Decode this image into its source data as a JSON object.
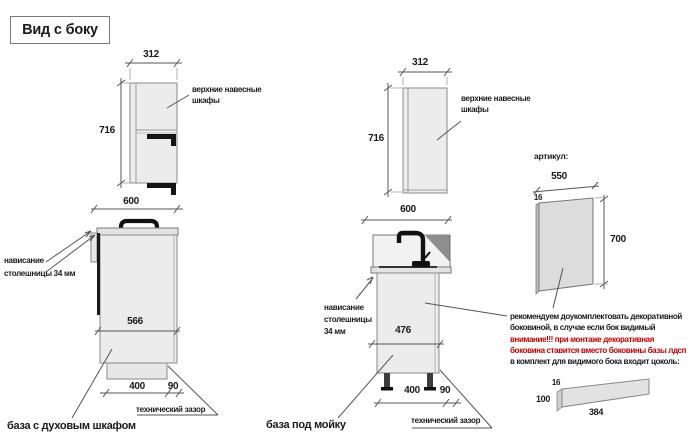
{
  "title": "Вид с боку",
  "units": {
    "oven_base": {
      "label": "база с духовым шкафом",
      "wall_width": "312",
      "wall_height": "716",
      "wall_callout": [
        "верхние навесные",
        "шкафы"
      ],
      "base_width": "600",
      "base_inner_width": "566",
      "plinth_width": "400",
      "tech_gap_width": "90",
      "overhang_note": [
        "нависание",
        "столешницы 34 мм"
      ],
      "tech_gap_label": "технический зазор"
    },
    "sink_base": {
      "label": "база под мойку",
      "wall_width": "312",
      "wall_height": "716",
      "wall_callout": [
        "верхние навесные",
        "шкафы"
      ],
      "base_width": "600",
      "base_inner_width": "476",
      "plinth_width": "400",
      "tech_gap_width": "90",
      "overhang_note": [
        "нависание",
        "столешницы",
        "34 мм"
      ],
      "tech_gap_label": "технический зазор"
    }
  },
  "side_panel": {
    "article_label": "артикул:",
    "width": "550",
    "thickness": "16",
    "height": "700",
    "note_black_1": "рекомендуем доукомплектовать декоративной",
    "note_black_2": "боковиной, в случае если бок видимый",
    "note_red_1": "внимание!!! при монтаже декоративная",
    "note_red_2": "боковина ставится вместо боковины базы лдсп",
    "note_black_3": "в комплект для видимого бока входит цоколь:",
    "plinth": {
      "thickness": "16",
      "height": "100",
      "length": "384"
    }
  },
  "colors": {
    "warning_red": "#c00000",
    "cabinet_fill": "#ececec"
  }
}
